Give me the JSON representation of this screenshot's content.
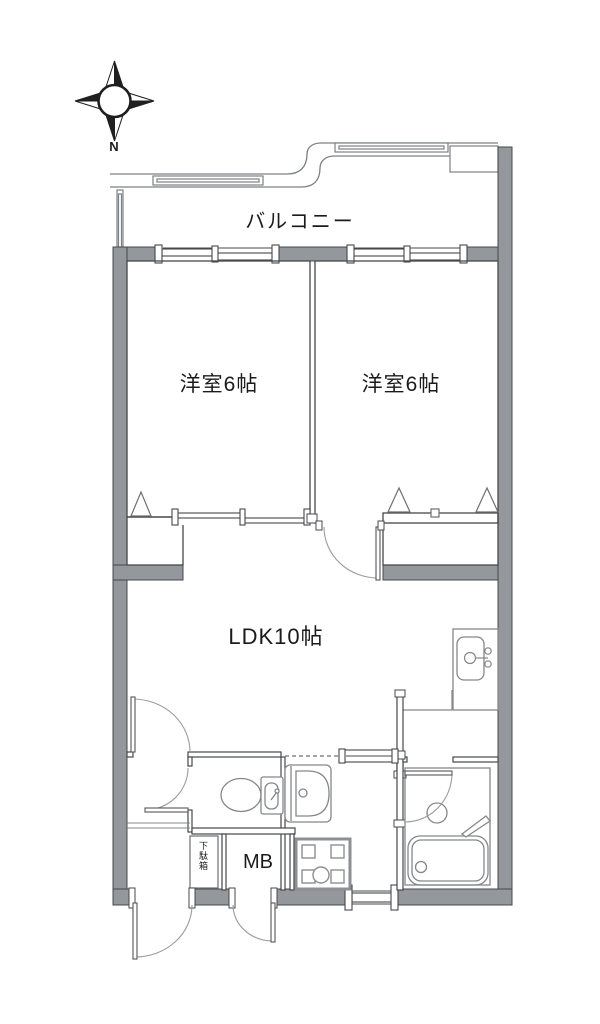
{
  "compass": {
    "north": "N"
  },
  "rooms": {
    "balcony": "バルコニー",
    "bedroom_left": "洋室6帖",
    "bedroom_right": "洋室6帖",
    "ldk": "LDK10帖"
  },
  "fixtures": {
    "meter_box": "MB",
    "shoe_cabinet": "下駄箱"
  },
  "colors": {
    "wall_fill": "#94979b",
    "structure_line": "#46484b",
    "fixture_line": "#85878a",
    "background": "#ffffff",
    "text": "#1b1b1b"
  }
}
